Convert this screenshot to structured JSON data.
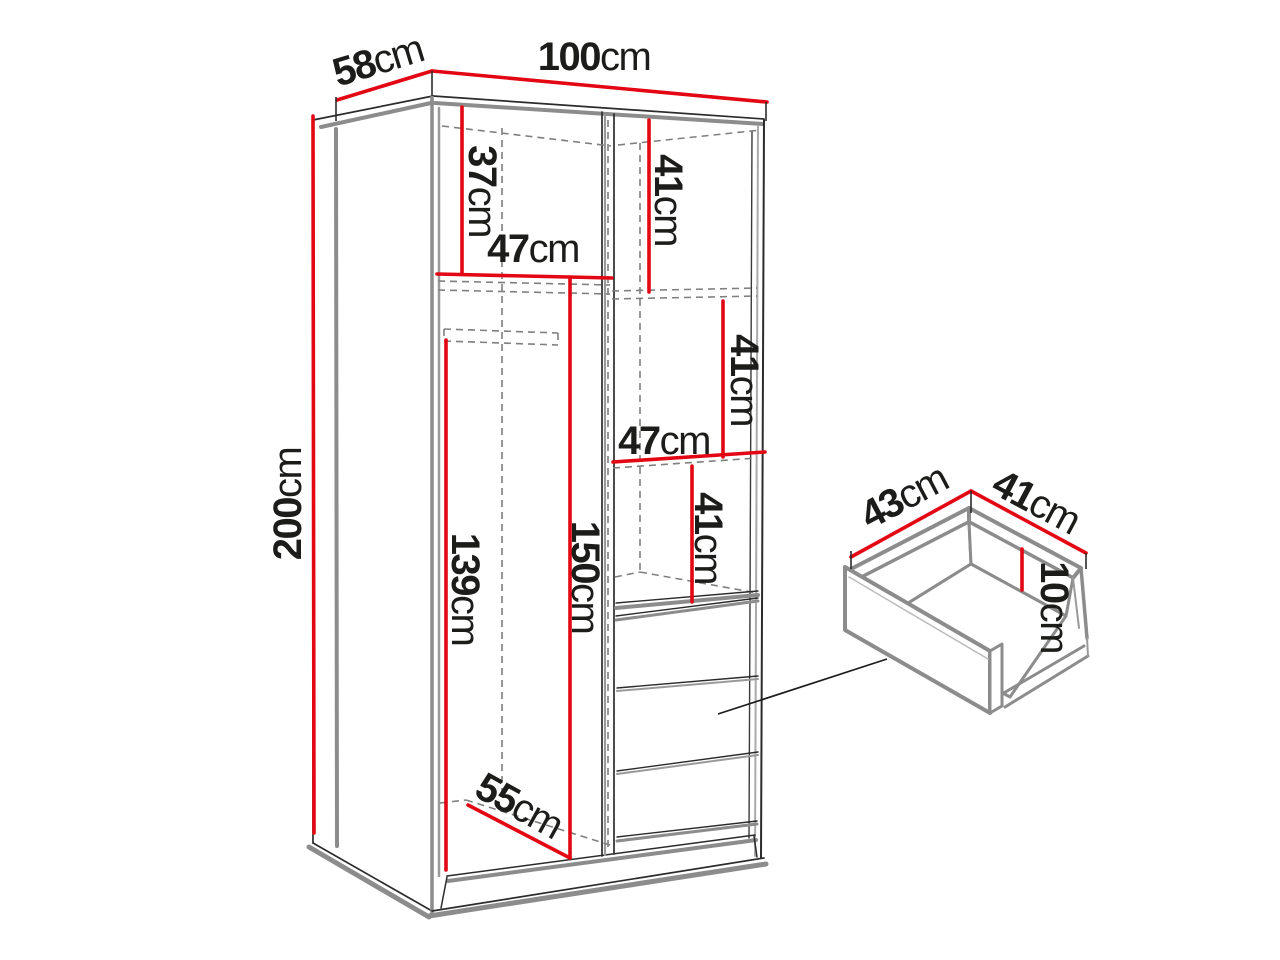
{
  "colors": {
    "dimension_red": "#e30613",
    "outline_black": "#2b2b2b",
    "shadow_gray": "#8c8c8c",
    "hidden_dashed_gray": "#7f7f7f",
    "label_text": "#1c1c1a",
    "background": "#ffffff"
  },
  "dimensions": {
    "depth_top": {
      "value": "58",
      "unit": "cm"
    },
    "width_top": {
      "value": "100",
      "unit": "cm"
    },
    "height_left": {
      "value": "200",
      "unit": "cm"
    },
    "left_upper_section_height": {
      "value": "37",
      "unit": "cm"
    },
    "left_shelf_width": {
      "value": "47",
      "unit": "cm"
    },
    "right_upper_section_height": {
      "value": "41",
      "unit": "cm"
    },
    "right_middle_section_height": {
      "value": "41",
      "unit": "cm"
    },
    "right_shelf_width": {
      "value": "47",
      "unit": "cm"
    },
    "right_lower_section_height": {
      "value": "41",
      "unit": "cm"
    },
    "left_rail_drop_height": {
      "value": "139",
      "unit": "cm"
    },
    "left_hanging_height": {
      "value": "150",
      "unit": "cm"
    },
    "interior_floor_depth": {
      "value": "55",
      "unit": "cm"
    },
    "drawer_depth": {
      "value": "43",
      "unit": "cm"
    },
    "drawer_width": {
      "value": "41",
      "unit": "cm"
    },
    "drawer_inner_height": {
      "value": "10",
      "unit": "cm"
    }
  }
}
